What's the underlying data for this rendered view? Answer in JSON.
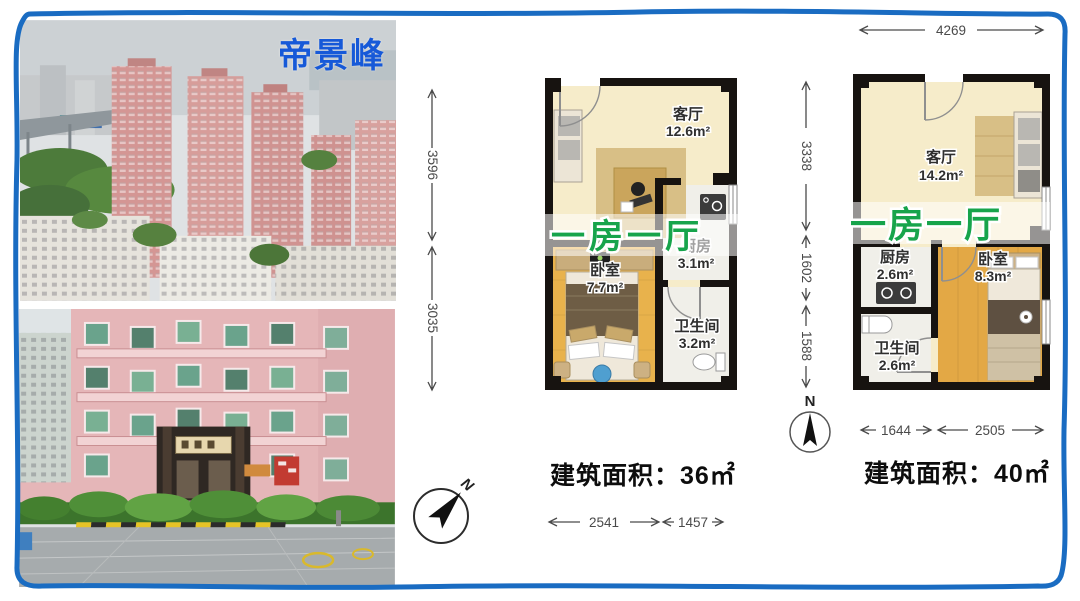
{
  "title": "帝景峰",
  "colors": {
    "border_blue": "#1a6cc2",
    "title_blue": "#1659d8",
    "overlay_green": "#17a44b",
    "wall_black": "#171310",
    "floor_cream": "#f6ecca",
    "floor_wood": "#e8b24c"
  },
  "photos": {
    "aerial_alt": "小区高层住宅航拍",
    "entrance_alt": "小区入口实景"
  },
  "plans": {
    "left": {
      "overlay_label": "一房一厅",
      "area_label": "建筑面积：36㎡",
      "rooms": {
        "living": {
          "name": "客厅",
          "area": "12.6m²"
        },
        "bedroom": {
          "name": "卧室",
          "area": "7.7m²"
        },
        "kitchen": {
          "name": "厨房",
          "area": "3.1m²"
        },
        "bath": {
          "name": "卫生间",
          "area": "3.2m²"
        }
      },
      "dims": {
        "v1": "3596",
        "v2": "3035",
        "b1": "2541",
        "b2": "1457"
      }
    },
    "right": {
      "overlay_label": "一房一厅",
      "area_label": "建筑面积：40㎡",
      "rooms": {
        "living": {
          "name": "客厅",
          "area": "14.2m²"
        },
        "kitchen": {
          "name": "厨房",
          "area": "2.6m²"
        },
        "bath": {
          "name": "卫生间",
          "area": "2.6m²"
        },
        "bedroom": {
          "name": "卧室",
          "area": "8.3m²"
        }
      },
      "dims": {
        "top": "4269",
        "v1": "3338",
        "v2": "1602",
        "v3": "1588",
        "b1": "1644",
        "b2": "2505"
      }
    }
  },
  "compass": {
    "north": "N"
  }
}
